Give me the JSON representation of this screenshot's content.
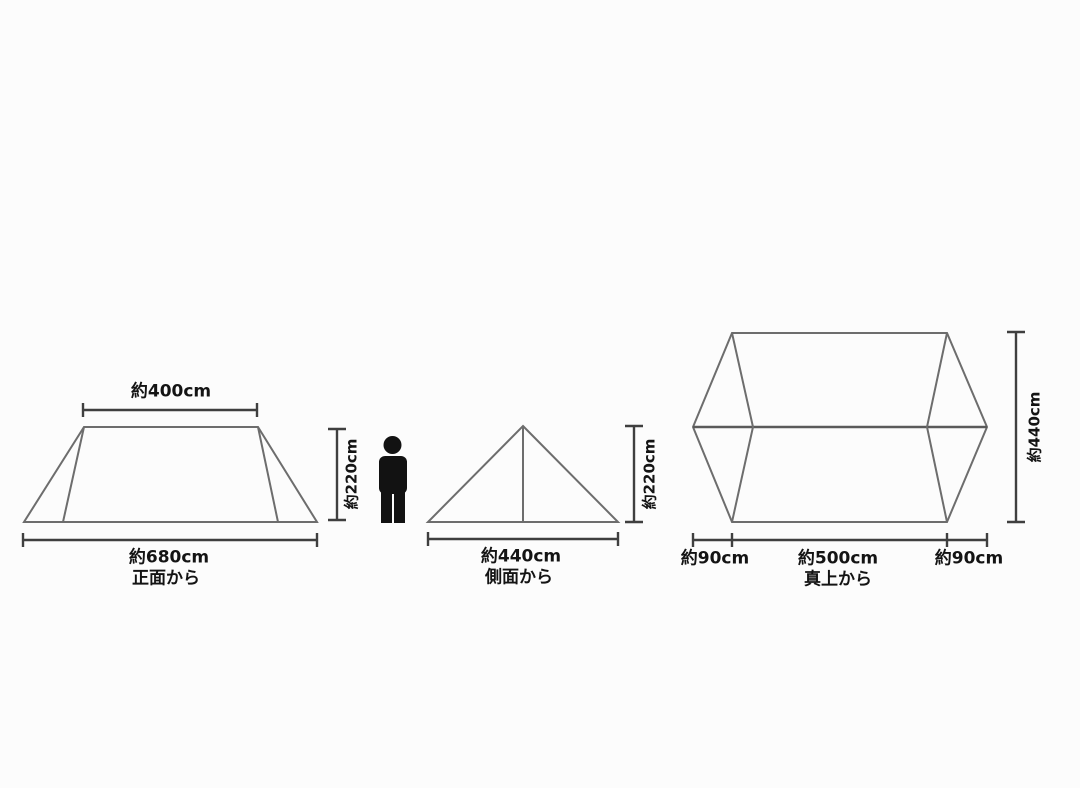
{
  "diagram": {
    "title": "tent-dimension-spec-drawing",
    "colors": {
      "background": "#fcfcfc",
      "shape_line": "#6d6d6d",
      "dimension_line": "#3f3f3f",
      "label_text": "#141414",
      "person_silhouette": "#121212"
    },
    "figures": {
      "front": {
        "view_label": "正面から",
        "top_width": "約400cm",
        "bottom_width": "約680cm",
        "height": "約220cm"
      },
      "side": {
        "view_label": "側面から",
        "bottom_width": "約440cm",
        "height": "約220cm"
      },
      "top": {
        "view_label": "真上から",
        "left_width": "約90cm",
        "center_width": "約500cm",
        "right_width": "約90cm",
        "depth": "約440cm"
      }
    }
  }
}
